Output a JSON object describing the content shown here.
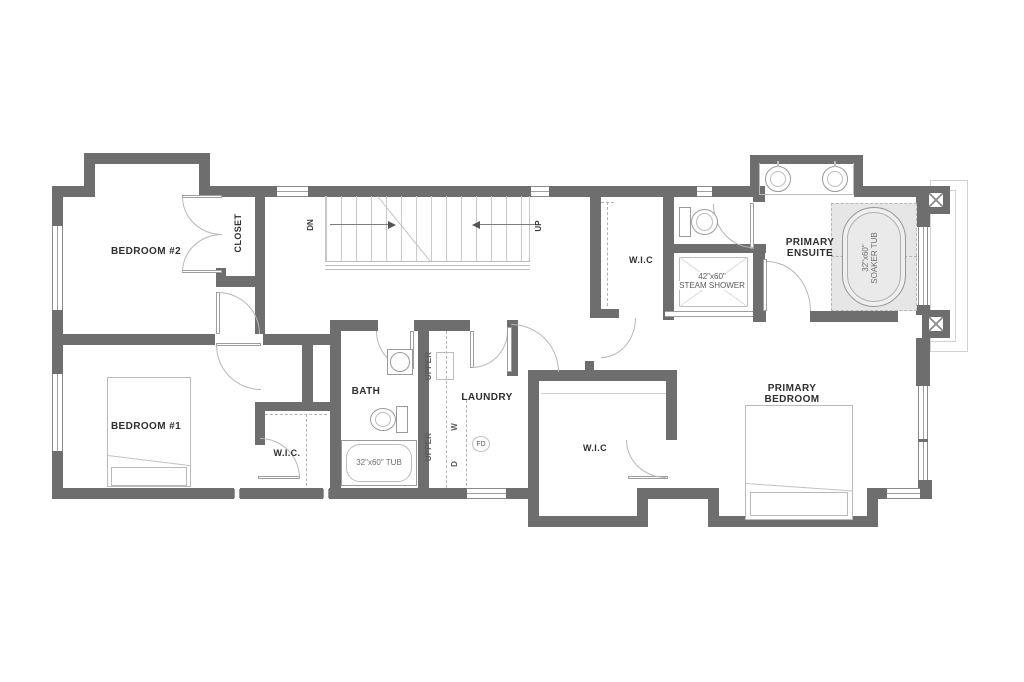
{
  "colors": {
    "wall": "#6e6e6e",
    "fixture_line": "#9a9a9a",
    "light_line": "#c6c6c6",
    "tub_platform_shade": "#e6e6e6",
    "label_text": "#2f2f2f",
    "dim_text": "#5a5a5a",
    "background": "#ffffff"
  },
  "rooms": {
    "bedroom2": "BEDROOM #2",
    "closet": "CLOSET",
    "bedroom1": "BEDROOM #1",
    "wic_bedroom1": "W.I.C.",
    "bath": "BATH",
    "laundry": "LAUNDRY",
    "wic_primary": "W.I.C",
    "primary_bedroom": "PRIMARY BEDROOM",
    "primary_ensuite": "PRIMARY ENSUITE",
    "wic_ensuite": "W.I.C"
  },
  "stairs": {
    "down": "DN",
    "up": "UP"
  },
  "fixtures": {
    "steam_shower_size": "42\"x60\"",
    "steam_shower_name": "STEAM SHOWER",
    "soaker_tub_size": "32\"x60\"",
    "soaker_tub_name": "SOAKER TUB",
    "bath_tub": "32\"x60\" TUB",
    "washer": "W",
    "dryer": "D",
    "floor_drain": "FD",
    "upper_cabinets": "UPPER"
  }
}
